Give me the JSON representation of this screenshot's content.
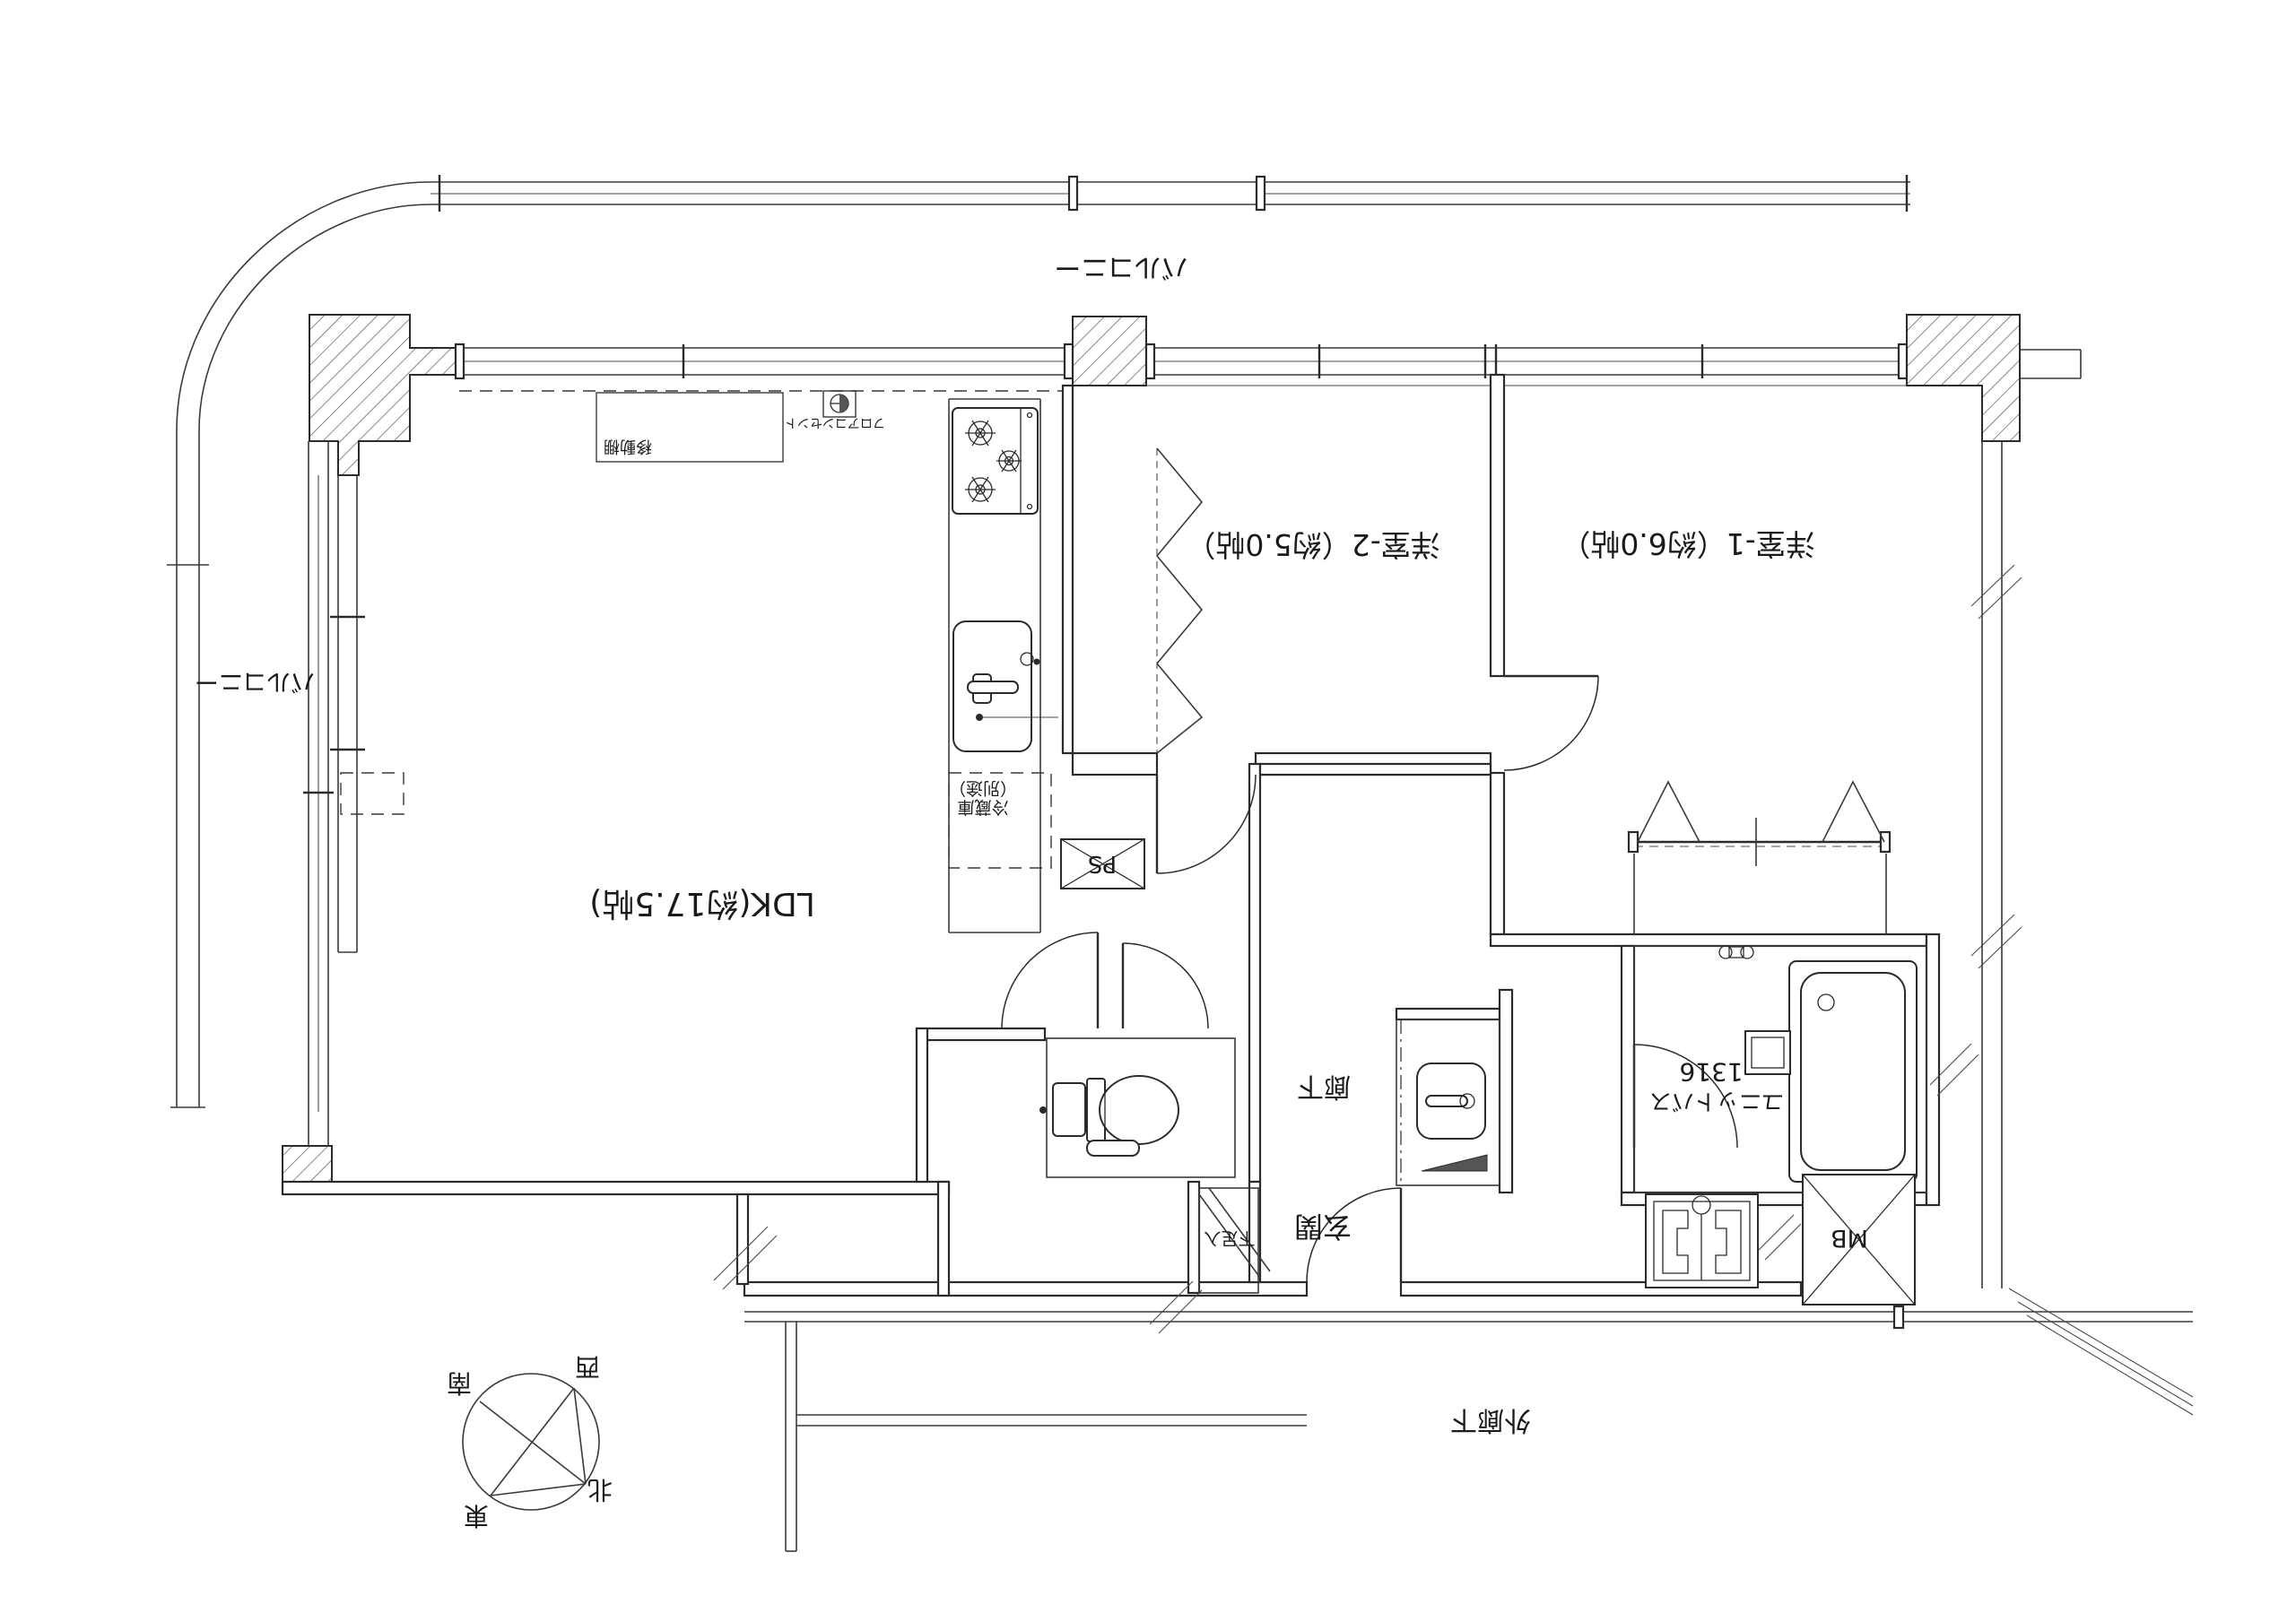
{
  "drawing": {
    "type": "apartment-floor-plan",
    "orientation_note": "plan printed rotated 180 degrees",
    "line_color": "#2b2b2b",
    "background_color": "#ffffff"
  },
  "rooms": {
    "ldk": "LDK(約17.5帖)",
    "bedroom1": "洋室-1（約6.0帖）",
    "bedroom2": "洋室-2（約5.0帖）",
    "hallway": "廊下",
    "entrance": "玄関",
    "outer_corridor": "外廊下"
  },
  "balcony": {
    "top_label": "バルコニー",
    "left_label": "バルコニー"
  },
  "fixtures": {
    "moving_shelf": "移動棚",
    "floor_outlet": "フロアコンセント",
    "fridge_line1": "冷蔵庫",
    "fridge_line2": "（別途）",
    "pipe_space": "PS",
    "meter_box": "MB",
    "unit_bath_line1": "1316",
    "unit_bath_line2": "ユニットバス",
    "shoe_cabinet": "下足入"
  },
  "compass": {
    "north": "北",
    "south": "南",
    "east": "東",
    "west": "西"
  }
}
